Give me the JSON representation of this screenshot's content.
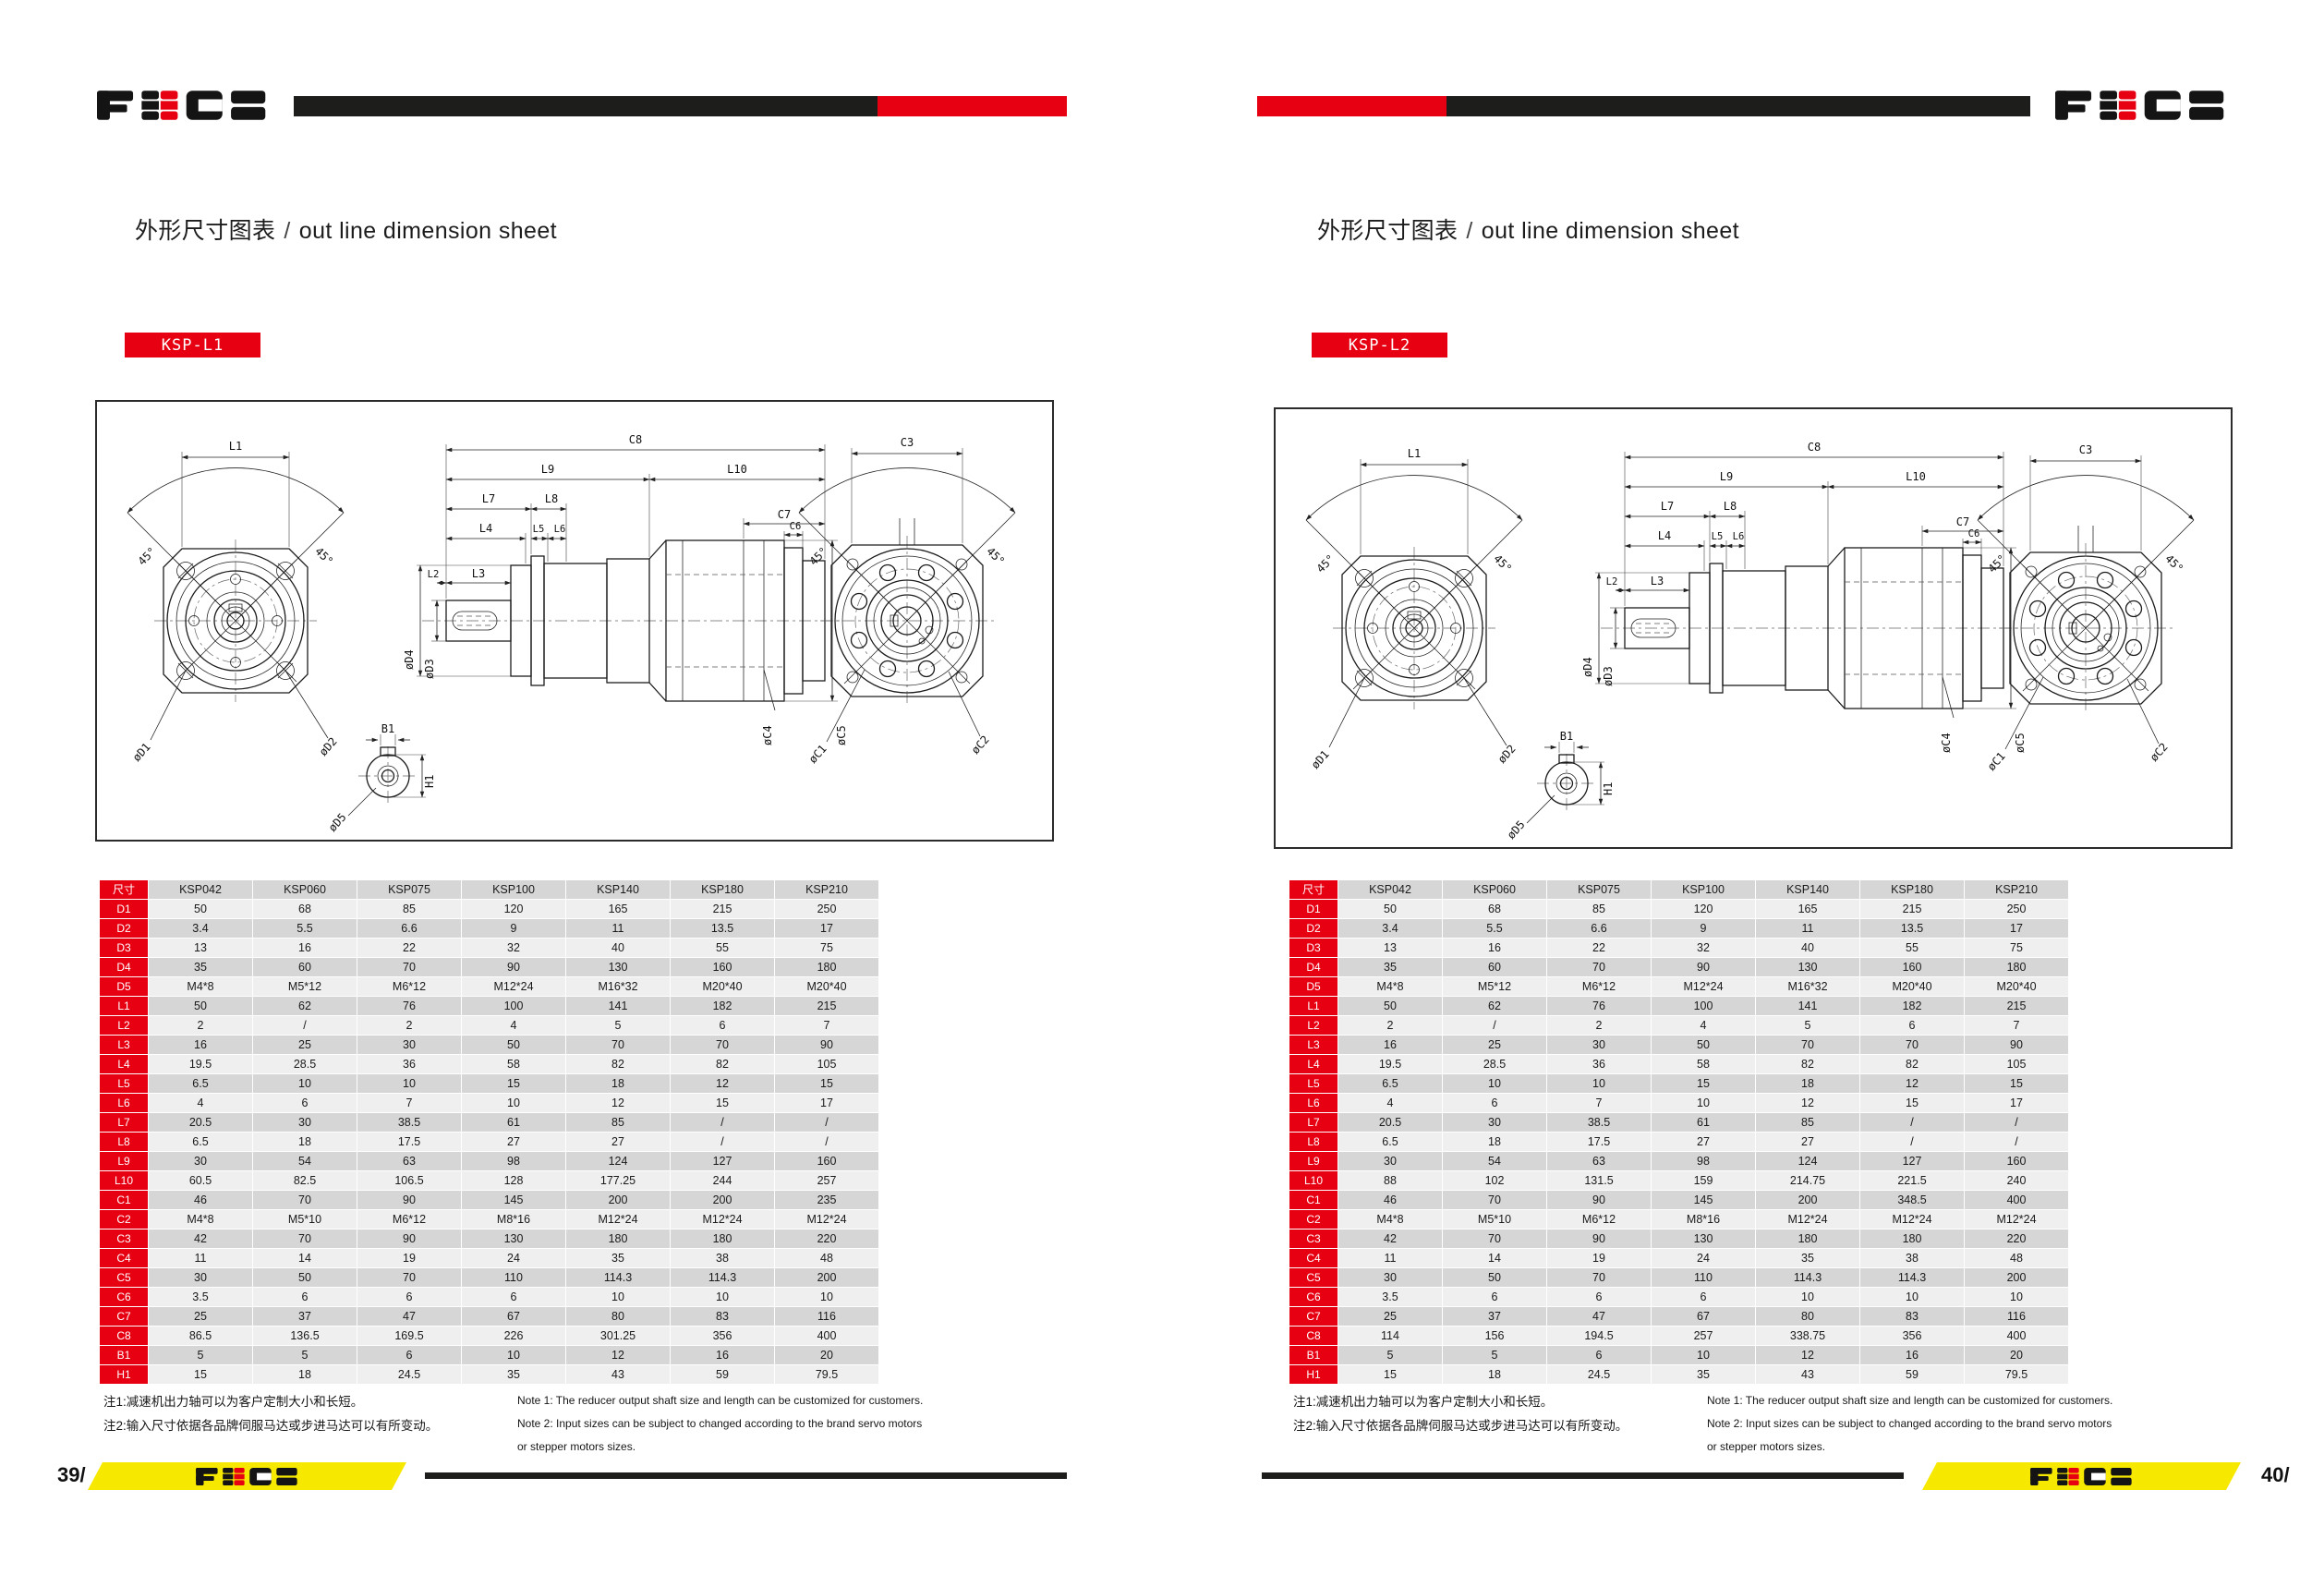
{
  "logo": {
    "name": "FECO"
  },
  "colors": {
    "accent_red": "#e60012",
    "footer_yellow": "#f7e800",
    "bar_black": "#1d1d1b",
    "table_gray_dark": "#d6d6d6",
    "table_gray_light": "#efefef"
  },
  "drawing_labels": {
    "l1": "L1",
    "angle": "45°",
    "d1": "øD1",
    "d2": "øD2",
    "c8": "C8",
    "l9": "L9",
    "l10": "L10",
    "l7": "L7",
    "l8": "L8",
    "c7": "C7",
    "l4": "L4",
    "l5": "L5",
    "l6": "L6",
    "c6": "C6",
    "l2": "L2",
    "l3": "L3",
    "d4": "øD4",
    "d3": "øD3",
    "c4": "øC4",
    "c5": "øC5",
    "c3": "C3",
    "c1": "øC1",
    "c2": "øC2",
    "b1": "B1",
    "h1": "H1",
    "d5": "øD5"
  },
  "pages": {
    "left": {
      "page_number": "39/",
      "title_zh": "外形尺寸图表",
      "title_sep": "/",
      "title_en": "out line dimension sheet",
      "model": "KSP-L1",
      "table": {
        "header": [
          "尺寸",
          "KSP042",
          "KSP060",
          "KSP075",
          "KSP100",
          "KSP140",
          "KSP180",
          "KSP210"
        ],
        "rows": [
          {
            "label": "D1",
            "values": [
              "50",
              "68",
              "85",
              "120",
              "165",
              "215",
              "250"
            ]
          },
          {
            "label": "D2",
            "values": [
              "3.4",
              "5.5",
              "6.6",
              "9",
              "11",
              "13.5",
              "17"
            ]
          },
          {
            "label": "D3",
            "values": [
              "13",
              "16",
              "22",
              "32",
              "40",
              "55",
              "75"
            ]
          },
          {
            "label": "D4",
            "values": [
              "35",
              "60",
              "70",
              "90",
              "130",
              "160",
              "180"
            ]
          },
          {
            "label": "D5",
            "values": [
              "M4*8",
              "M5*12",
              "M6*12",
              "M12*24",
              "M16*32",
              "M20*40",
              "M20*40"
            ]
          },
          {
            "label": "L1",
            "values": [
              "50",
              "62",
              "76",
              "100",
              "141",
              "182",
              "215"
            ]
          },
          {
            "label": "L2",
            "values": [
              "2",
              "/",
              "2",
              "4",
              "5",
              "6",
              "7"
            ]
          },
          {
            "label": "L3",
            "values": [
              "16",
              "25",
              "30",
              "50",
              "70",
              "70",
              "90"
            ]
          },
          {
            "label": "L4",
            "values": [
              "19.5",
              "28.5",
              "36",
              "58",
              "82",
              "82",
              "105"
            ]
          },
          {
            "label": "L5",
            "values": [
              "6.5",
              "10",
              "10",
              "15",
              "18",
              "12",
              "15"
            ]
          },
          {
            "label": "L6",
            "values": [
              "4",
              "6",
              "7",
              "10",
              "12",
              "15",
              "17"
            ]
          },
          {
            "label": "L7",
            "values": [
              "20.5",
              "30",
              "38.5",
              "61",
              "85",
              "/",
              "/"
            ]
          },
          {
            "label": "L8",
            "values": [
              "6.5",
              "18",
              "17.5",
              "27",
              "27",
              "/",
              "/"
            ]
          },
          {
            "label": "L9",
            "values": [
              "30",
              "54",
              "63",
              "98",
              "124",
              "127",
              "160"
            ]
          },
          {
            "label": "L10",
            "values": [
              "60.5",
              "82.5",
              "106.5",
              "128",
              "177.25",
              "244",
              "257"
            ]
          },
          {
            "label": "C1",
            "values": [
              "46",
              "70",
              "90",
              "145",
              "200",
              "200",
              "235"
            ]
          },
          {
            "label": "C2",
            "values": [
              "M4*8",
              "M5*10",
              "M6*12",
              "M8*16",
              "M12*24",
              "M12*24",
              "M12*24"
            ]
          },
          {
            "label": "C3",
            "values": [
              "42",
              "70",
              "90",
              "130",
              "180",
              "180",
              "220"
            ]
          },
          {
            "label": "C4",
            "values": [
              "11",
              "14",
              "19",
              "24",
              "35",
              "38",
              "48"
            ]
          },
          {
            "label": "C5",
            "values": [
              "30",
              "50",
              "70",
              "110",
              "114.3",
              "114.3",
              "200"
            ]
          },
          {
            "label": "C6",
            "values": [
              "3.5",
              "6",
              "6",
              "6",
              "10",
              "10",
              "10"
            ]
          },
          {
            "label": "C7",
            "values": [
              "25",
              "37",
              "47",
              "67",
              "80",
              "83",
              "116"
            ]
          },
          {
            "label": "C8",
            "values": [
              "86.5",
              "136.5",
              "169.5",
              "226",
              "301.25",
              "356",
              "400"
            ]
          },
          {
            "label": "B1",
            "values": [
              "5",
              "5",
              "6",
              "10",
              "12",
              "16",
              "20"
            ]
          },
          {
            "label": "H1",
            "values": [
              "15",
              "18",
              "24.5",
              "35",
              "43",
              "59",
              "79.5"
            ]
          }
        ]
      },
      "notes_zh": [
        "注1:减速机出力轴可以为客户定制大小和长短。",
        "注2:输入尺寸依据各品牌伺服马达或步进马达可以有所变动。"
      ],
      "notes_en": [
        "Note 1: The reducer output shaft size and length can be customized for customers.",
        "Note 2: Input sizes can be subject to changed according to the brand servo motors",
        "or stepper motors sizes."
      ]
    },
    "right": {
      "page_number": "40/",
      "title_zh": "外形尺寸图表",
      "title_sep": "/",
      "title_en": "out line dimension sheet",
      "model": "KSP-L2",
      "table": {
        "header": [
          "尺寸",
          "KSP042",
          "KSP060",
          "KSP075",
          "KSP100",
          "KSP140",
          "KSP180",
          "KSP210"
        ],
        "rows": [
          {
            "label": "D1",
            "values": [
              "50",
              "68",
              "85",
              "120",
              "165",
              "215",
              "250"
            ]
          },
          {
            "label": "D2",
            "values": [
              "3.4",
              "5.5",
              "6.6",
              "9",
              "11",
              "13.5",
              "17"
            ]
          },
          {
            "label": "D3",
            "values": [
              "13",
              "16",
              "22",
              "32",
              "40",
              "55",
              "75"
            ]
          },
          {
            "label": "D4",
            "values": [
              "35",
              "60",
              "70",
              "90",
              "130",
              "160",
              "180"
            ]
          },
          {
            "label": "D5",
            "values": [
              "M4*8",
              "M5*12",
              "M6*12",
              "M12*24",
              "M16*32",
              "M20*40",
              "M20*40"
            ]
          },
          {
            "label": "L1",
            "values": [
              "50",
              "62",
              "76",
              "100",
              "141",
              "182",
              "215"
            ]
          },
          {
            "label": "L2",
            "values": [
              "2",
              "/",
              "2",
              "4",
              "5",
              "6",
              "7"
            ]
          },
          {
            "label": "L3",
            "values": [
              "16",
              "25",
              "30",
              "50",
              "70",
              "70",
              "90"
            ]
          },
          {
            "label": "L4",
            "values": [
              "19.5",
              "28.5",
              "36",
              "58",
              "82",
              "82",
              "105"
            ]
          },
          {
            "label": "L5",
            "values": [
              "6.5",
              "10",
              "10",
              "15",
              "18",
              "12",
              "15"
            ]
          },
          {
            "label": "L6",
            "values": [
              "4",
              "6",
              "7",
              "10",
              "12",
              "15",
              "17"
            ]
          },
          {
            "label": "L7",
            "values": [
              "20.5",
              "30",
              "38.5",
              "61",
              "85",
              "/",
              "/"
            ]
          },
          {
            "label": "L8",
            "values": [
              "6.5",
              "18",
              "17.5",
              "27",
              "27",
              "/",
              "/"
            ]
          },
          {
            "label": "L9",
            "values": [
              "30",
              "54",
              "63",
              "98",
              "124",
              "127",
              "160"
            ]
          },
          {
            "label": "L10",
            "values": [
              "88",
              "102",
              "131.5",
              "159",
              "214.75",
              "221.5",
              "240"
            ]
          },
          {
            "label": "C1",
            "values": [
              "46",
              "70",
              "90",
              "145",
              "200",
              "348.5",
              "400"
            ]
          },
          {
            "label": "C2",
            "values": [
              "M4*8",
              "M5*10",
              "M6*12",
              "M8*16",
              "M12*24",
              "M12*24",
              "M12*24"
            ]
          },
          {
            "label": "C3",
            "values": [
              "42",
              "70",
              "90",
              "130",
              "180",
              "180",
              "220"
            ]
          },
          {
            "label": "C4",
            "values": [
              "11",
              "14",
              "19",
              "24",
              "35",
              "38",
              "48"
            ]
          },
          {
            "label": "C5",
            "values": [
              "30",
              "50",
              "70",
              "110",
              "114.3",
              "114.3",
              "200"
            ]
          },
          {
            "label": "C6",
            "values": [
              "3.5",
              "6",
              "6",
              "6",
              "10",
              "10",
              "10"
            ]
          },
          {
            "label": "C7",
            "values": [
              "25",
              "37",
              "47",
              "67",
              "80",
              "83",
              "116"
            ]
          },
          {
            "label": "C8",
            "values": [
              "114",
              "156",
              "194.5",
              "257",
              "338.75",
              "356",
              "400"
            ]
          },
          {
            "label": "B1",
            "values": [
              "5",
              "5",
              "6",
              "10",
              "12",
              "16",
              "20"
            ]
          },
          {
            "label": "H1",
            "values": [
              "15",
              "18",
              "24.5",
              "35",
              "43",
              "59",
              "79.5"
            ]
          }
        ]
      },
      "notes_zh": [
        "注1:减速机出力轴可以为客户定制大小和长短。",
        "注2:输入尺寸依据各品牌伺服马达或步进马达可以有所变动。"
      ],
      "notes_en": [
        "Note 1: The reducer output shaft size and length can be customized for customers.",
        "Note 2: Input sizes can be subject to changed according to the brand servo motors",
        "or stepper motors sizes."
      ]
    }
  }
}
